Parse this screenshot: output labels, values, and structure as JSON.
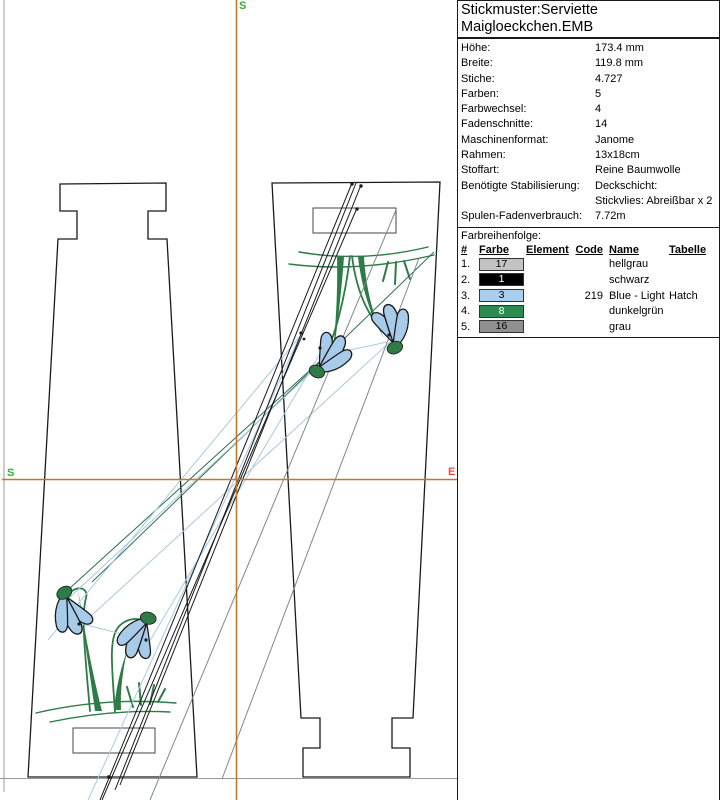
{
  "panel": {
    "title_line1": "Stickmuster:Serviette",
    "title_line2": "Maigloeckchen.EMB",
    "details": {
      "rows": [
        {
          "label": "Höhe:",
          "value": "173.4 mm"
        },
        {
          "label": "Breite:",
          "value": "119.8 mm"
        },
        {
          "label": "Stiche:",
          "value": "4.727"
        },
        {
          "label": "Farben:",
          "value": "5"
        },
        {
          "label": "Farbwechsel:",
          "value": "4"
        },
        {
          "label": "Fadenschnitte:",
          "value": "14"
        },
        {
          "label": "Maschinenformat:",
          "value": "Janome"
        },
        {
          "label": "Rahmen:",
          "value": "13x18cm"
        },
        {
          "label": "Stoffart:",
          "value": "Reine Baumwolle"
        },
        {
          "label": "Benötigte Stabilisierung:",
          "value": "Deckschicht:\nStickvlies: Abreißbar x 2"
        },
        {
          "label": "Spulen-Fadenverbrauch:",
          "value": "7.72m"
        }
      ]
    },
    "color_sequence": {
      "section_label": "Farbreihenfolge:",
      "headers": {
        "num": "#",
        "farbe": "Farbe",
        "element": "Element",
        "code": "Code",
        "name": "Name",
        "tabelle": "Tabelle"
      },
      "rows": [
        {
          "num": "1.",
          "swatch_label": "17",
          "swatch_color": "#c3c3c3",
          "swatch_text_color": "#000000",
          "element": "",
          "code": "",
          "name": "hellgrau",
          "tabelle": ""
        },
        {
          "num": "2.",
          "swatch_label": "1",
          "swatch_color": "#000000",
          "swatch_text_color": "#ffffff",
          "element": "",
          "code": "",
          "name": "schwarz",
          "tabelle": ""
        },
        {
          "num": "3.",
          "swatch_label": "3",
          "swatch_color": "#a8cef0",
          "swatch_text_color": "#000000",
          "element": "",
          "code": "219",
          "name": "Blue - Light",
          "tabelle": "Hatch"
        },
        {
          "num": "4.",
          "swatch_label": "8",
          "swatch_color": "#2e8b50",
          "swatch_text_color": "#ffffff",
          "element": "",
          "code": "",
          "name": "dunkelgrün",
          "tabelle": ""
        },
        {
          "num": "5.",
          "swatch_label": "16",
          "swatch_color": "#8f8f8f",
          "swatch_text_color": "#000000",
          "element": "",
          "code": "",
          "name": "grau",
          "tabelle": ""
        }
      ]
    }
  },
  "canvas": {
    "markers": {
      "start_top": "S",
      "start_left": "S",
      "end_right": "E"
    },
    "colors": {
      "crosshair": "#c0782a",
      "start_marker": "#3aad3a",
      "end_marker": "#e8503e",
      "design_green": "#2e7b47",
      "design_blue": "#a7cbe9",
      "outline": "#1a1a1a",
      "travel_blue": "#a9c9e2",
      "travel_teal": "#2e6b52",
      "travel_gray": "#808888",
      "border_gray": "#999999"
    }
  }
}
